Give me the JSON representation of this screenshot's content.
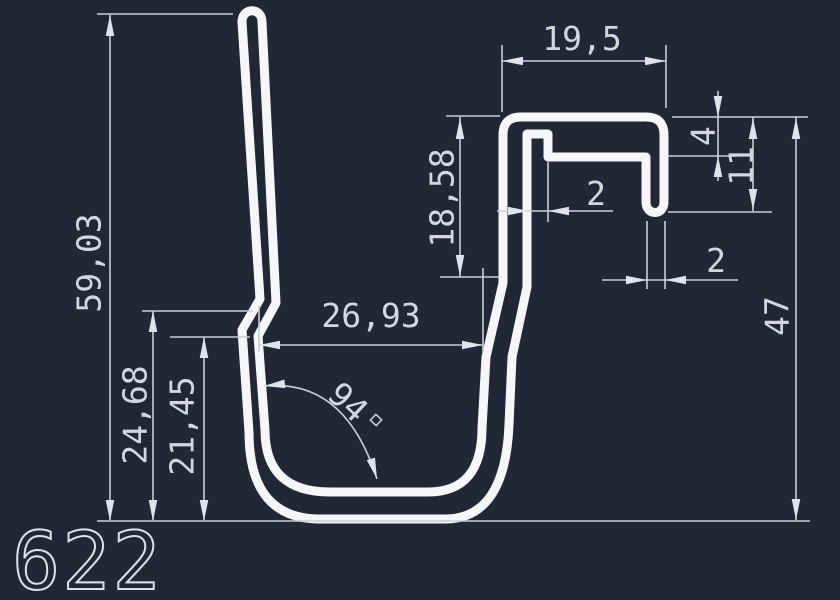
{
  "drawing": {
    "part_number": "622",
    "dimensions": {
      "overall_height": "59,03",
      "leg_height_outer": "24,68",
      "leg_height_inner": "21,45",
      "opening_width": "26,93",
      "channel_depth": "18,58",
      "top_width": "19,5",
      "lip_inset": "4",
      "hook_height": "11",
      "channel_wall": "2",
      "hook_wall": "2",
      "right_height": "47",
      "bottom_angle": "94",
      "bottom_angle_unit": "°"
    },
    "colors": {
      "background": "#212734",
      "profile_line": "#f4f6f9",
      "dimension_line": "#c9cfd9",
      "dimension_text": "#d2d7e0"
    }
  }
}
